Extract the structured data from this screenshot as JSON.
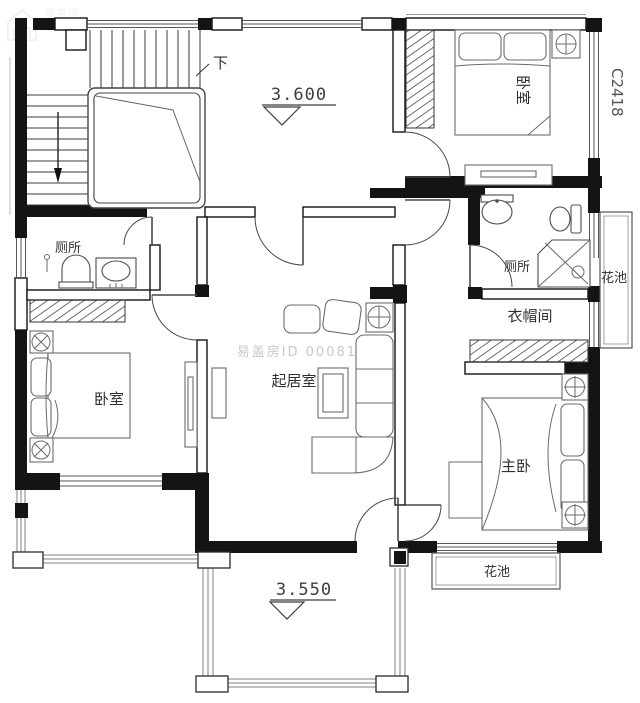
{
  "labels": {
    "stairs_down": "下",
    "upper_floor_level": "3.600",
    "terrace_level": "3.550",
    "bedroom_top_right": "卧室",
    "bedroom_left": "卧室",
    "master_bedroom": "主卧",
    "living_room": "起居室",
    "toilet_left": "厕所",
    "toilet_right": "厕所",
    "cloakroom": "衣帽间",
    "flower_bed_right": "花池",
    "flower_bed_bottom": "花池",
    "window_code": "C2418"
  },
  "watermarks": {
    "center_id": "易盖房ID 000817",
    "brand": "易盖房"
  },
  "colors": {
    "wall": "#141414",
    "thin_line": "#555555",
    "furniture_line": "#6b6b6b",
    "watermark": "#c9c9c9",
    "background": "#ffffff"
  }
}
